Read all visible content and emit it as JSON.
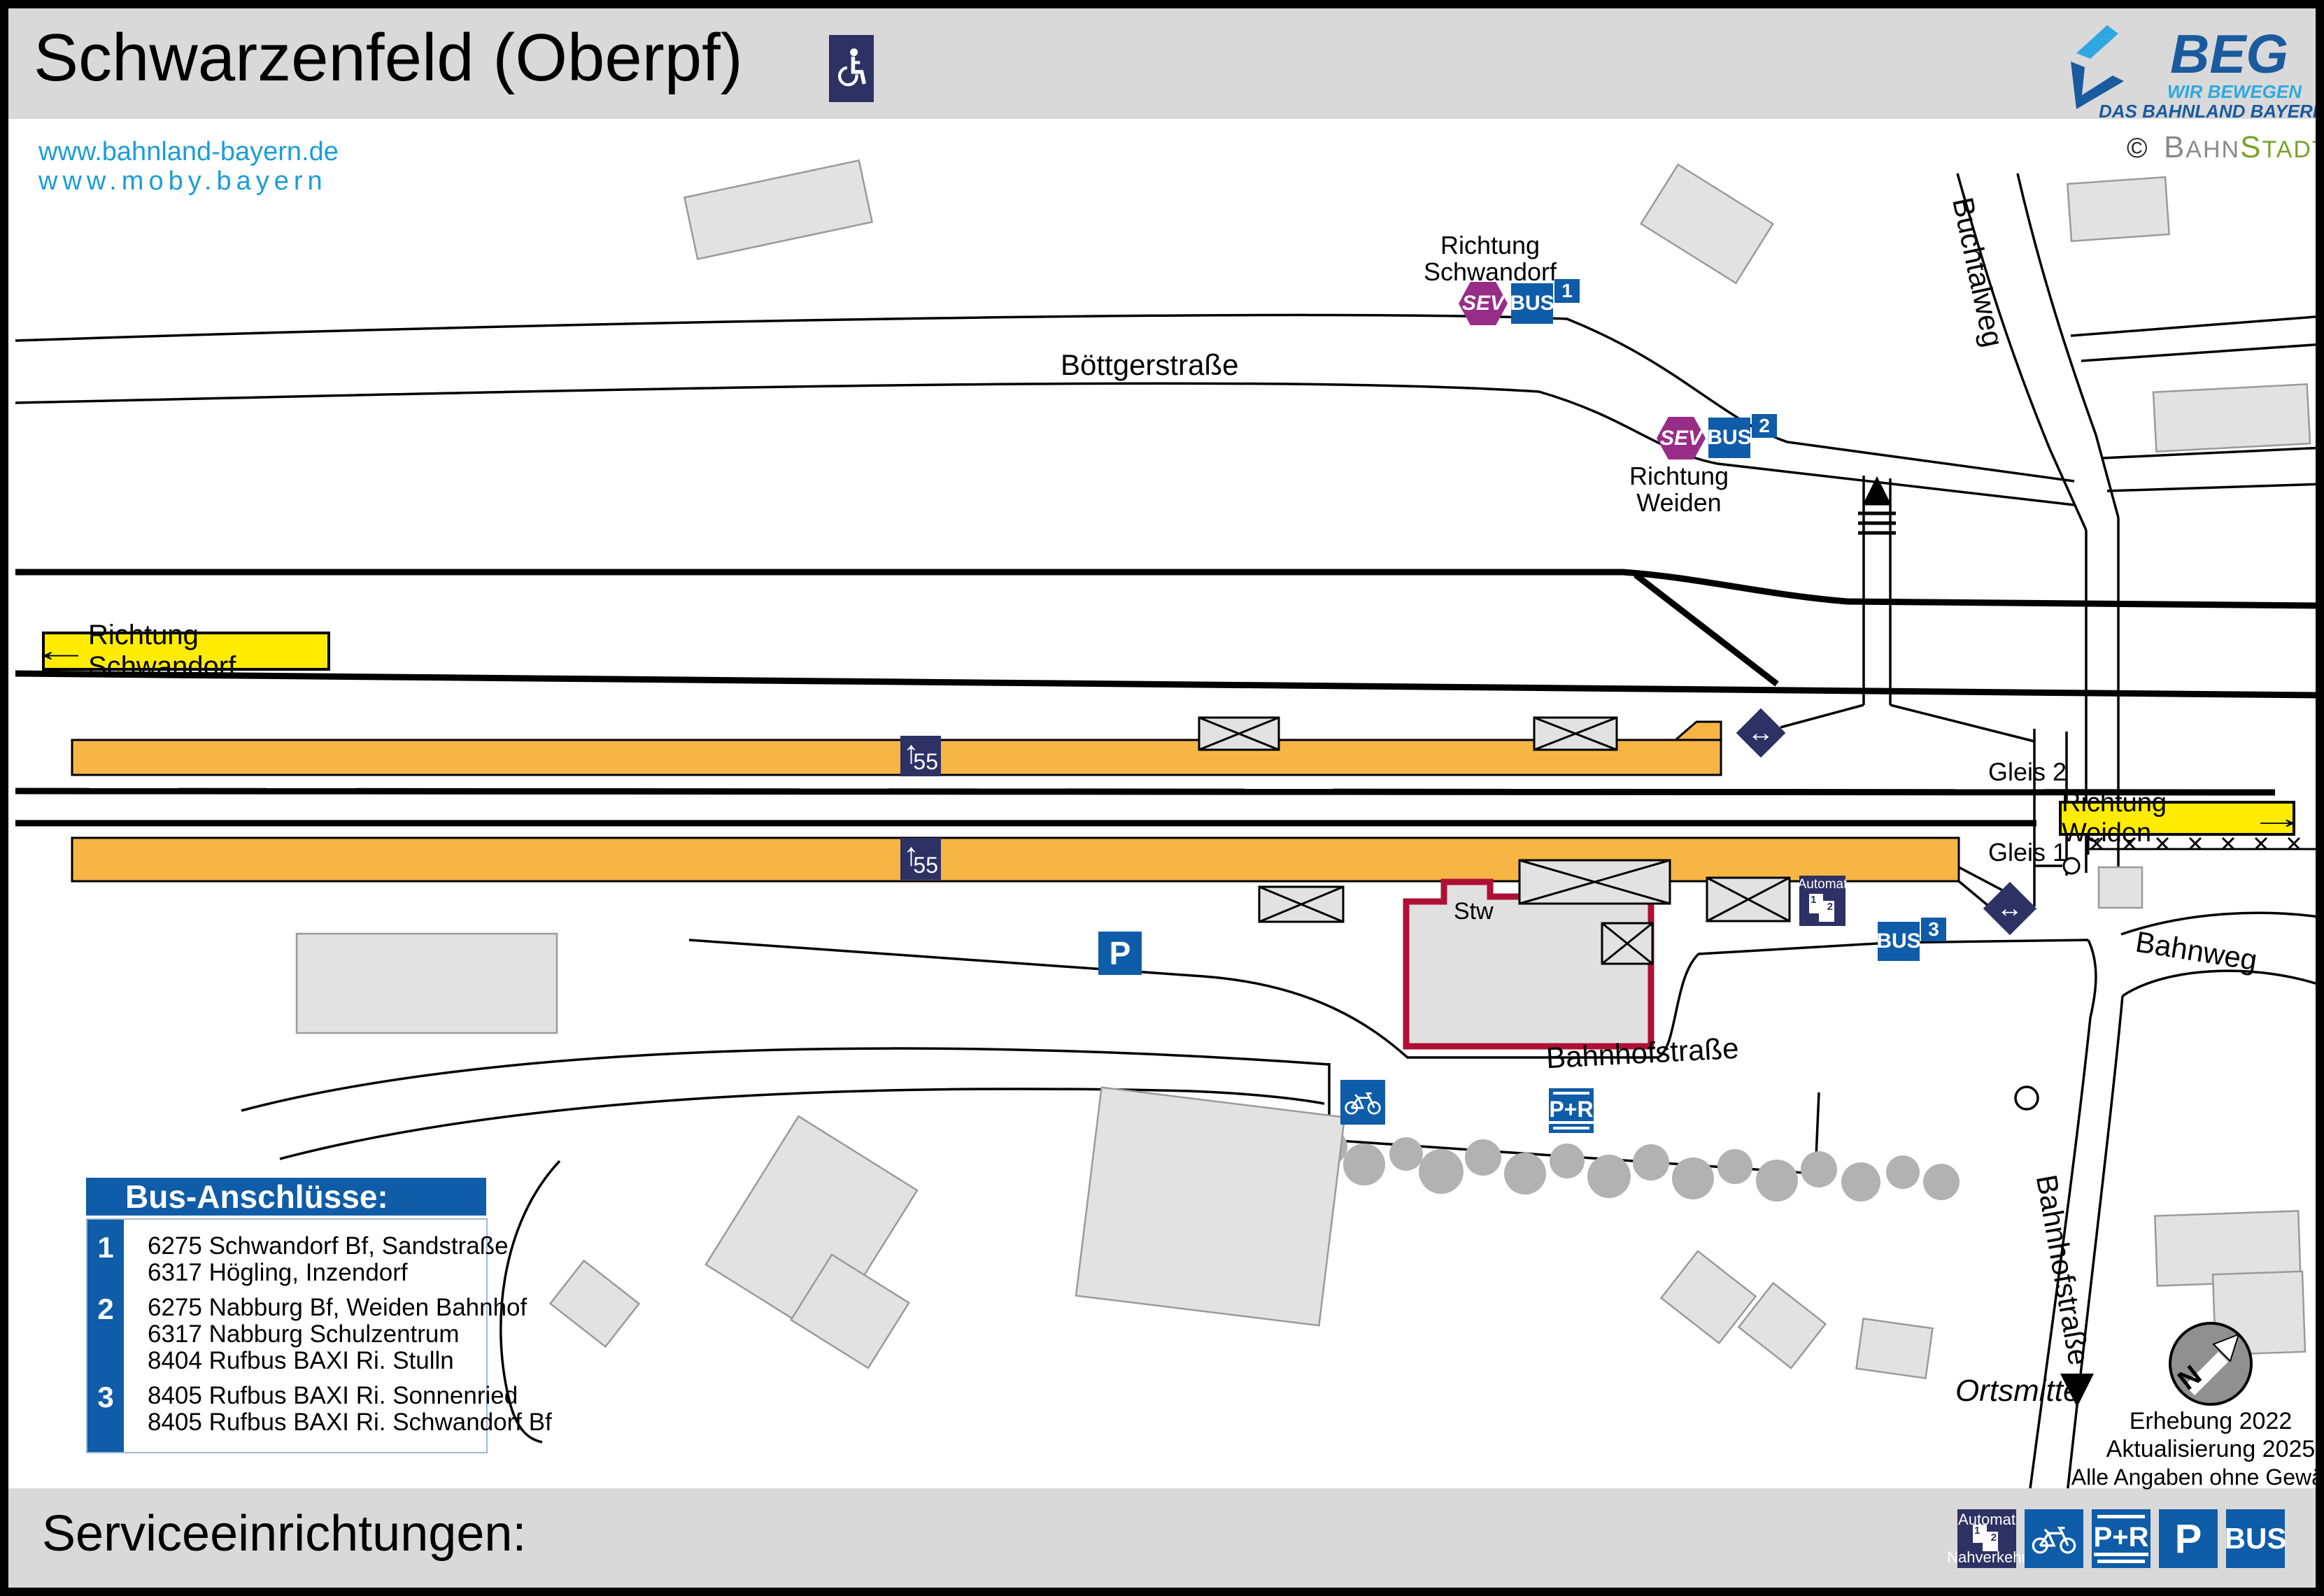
{
  "header": {
    "title": "Schwarzenfeld (Oberpf)",
    "links": {
      "line1": "www.bahnland-bayern.de",
      "line2": "www.moby.bayern"
    },
    "beg": {
      "abbr": "BEG",
      "tagline1": "WIR BEWEGEN",
      "tagline2": "DAS BAHNLAND BAYERN"
    },
    "credit": {
      "symbol": "©",
      "gray_big": "B",
      "gray_rest": "AHN",
      "green_big": "S",
      "green_rest": "TADT"
    }
  },
  "map": {
    "streets": {
      "boettgerstrasse": "Böttgerstraße",
      "buchtalweg": "Buchtalweg",
      "bahnhofstrasse": "Bahnhofstraße",
      "bahnhofstrasse_south": "Bahnhofstraße",
      "bahnweg": "Bahnweg"
    },
    "direction_signs": {
      "left": {
        "arrow": "←",
        "label": "Richtung Schwandorf"
      },
      "right": {
        "label": "Richtung Weiden",
        "arrow": "→"
      }
    },
    "bus_stops": {
      "stop1": {
        "sev": "SEV",
        "bus": "BUS",
        "number": "1",
        "direction_line1": "Richtung",
        "direction_line2": "Schwandorf"
      },
      "stop2": {
        "sev": "SEV",
        "bus": "BUS",
        "number": "2",
        "direction_line1": "Richtung",
        "direction_line2": "Weiden"
      },
      "stop3": {
        "bus": "BUS",
        "number": "3"
      }
    },
    "platforms": {
      "gleis1": "Gleis 1",
      "gleis2": "Gleis 2",
      "height_marker": "55",
      "arrow": "↑"
    },
    "station": {
      "stw": "Stw"
    },
    "icons": {
      "automat": "Automat",
      "automat_machine_1": "1",
      "automat_machine_2": "2",
      "parking": "P",
      "park_ride": "P+R",
      "ramp_arrow": "↔"
    },
    "ortsmitte": "Ortsmitte",
    "compass_letter": "N",
    "notes": {
      "line1": "Erhebung 2022",
      "line2": "Aktualisierung 2025",
      "line3": "Alle Angaben ohne Gewähr!"
    },
    "legend": {
      "title": "Bus-Anschlüsse:",
      "groups": [
        {
          "number": "1",
          "lines": [
            "6275 Schwandorf Bf, Sandstraße",
            "6317 Högling, Inzendorf"
          ]
        },
        {
          "number": "2",
          "lines": [
            "6275 Nabburg Bf, Weiden Bahnhof",
            "6317 Nabburg Schulzentrum",
            "8404 Rufbus BAXI Ri. Stulln"
          ]
        },
        {
          "number": "3",
          "lines": [
            "8405 Rufbus BAXI Ri. Sonnenried",
            "8405 Rufbus BAXI Ri. Schwandorf Bf"
          ]
        }
      ]
    }
  },
  "footer": {
    "label": "Serviceeinrichtungen:",
    "icons": {
      "automat_top": "Automat",
      "automat_bottom": "Nahverkehr",
      "pr": "P+R",
      "p": "P",
      "bus": "BUS"
    }
  },
  "colors": {
    "navy": "#2d3164",
    "blue": "#0f5ca8",
    "sev_magenta": "#982d87",
    "platform_orange": "#f6b545",
    "signal_yellow": "#ffec00",
    "stw_red": "#ae1035",
    "link_blue": "#1b9dd9",
    "beg_dark_blue": "#1a5a9e",
    "beg_light_blue": "#2fa8e1",
    "bahnstadt_green": "#7aa22b",
    "bahnstadt_gray": "#8a8a8a"
  }
}
